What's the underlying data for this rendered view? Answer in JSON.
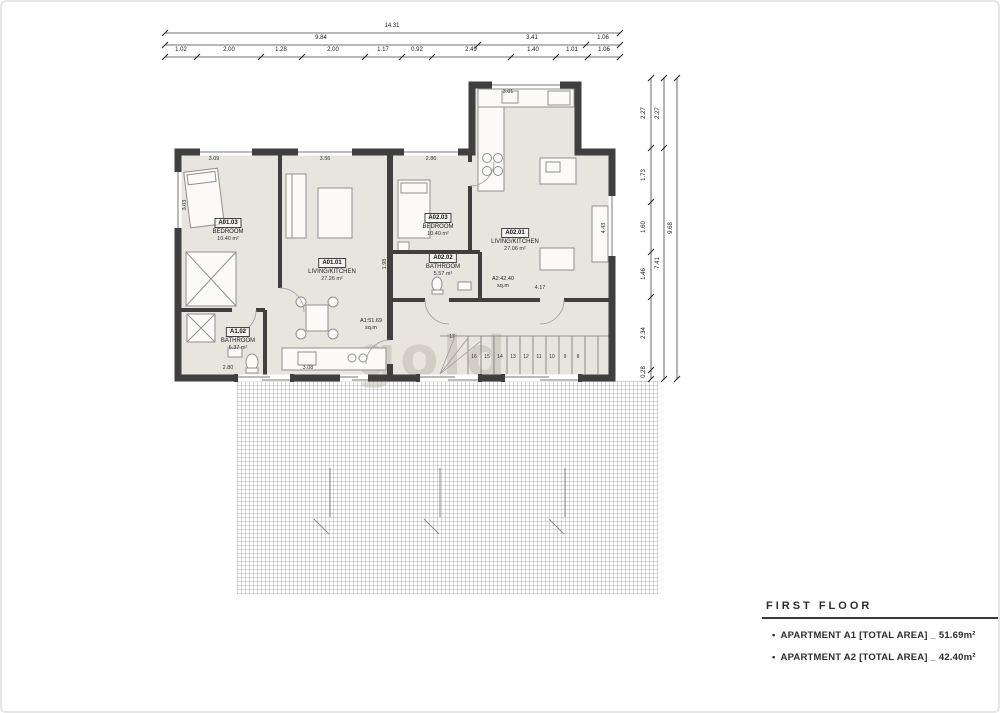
{
  "watermark": "gold",
  "colors": {
    "wall": "#3f3f3f",
    "floor": "#e8e5df",
    "hatch": "#9a9a9a"
  },
  "legend": {
    "title": "FIRST FLOOR",
    "bullet": "•",
    "items": [
      {
        "text": "APARTMENT A1 [TOTAL AREA] _ 51.69m²"
      },
      {
        "text": "APARTMENT A2 [TOTAL AREA] _ 42.40m²"
      }
    ]
  },
  "dimensions": {
    "top": {
      "total": "14.31",
      "row2": [
        "9.84",
        "3.41",
        "1.06"
      ],
      "row3": [
        "1.02",
        "2.00",
        "1.28",
        "2.00",
        "1.17",
        "0.92",
        "2.49",
        "1.40",
        "1.01",
        "1.06"
      ]
    },
    "right": {
      "total": "9.68",
      "row2": [
        "2.27",
        "7.41"
      ],
      "row3": [
        "2.27",
        "1.73",
        "1.60",
        "1.46",
        "2.34",
        "0.28"
      ]
    },
    "interior": [
      "3.09",
      "3.56",
      "2.86",
      "3.01",
      "4.17",
      "1.98",
      "2.80",
      "3.08",
      "4.43",
      "3.03"
    ]
  },
  "rooms": [
    {
      "id": "A01.03",
      "name": "BEDROOM",
      "area": "10.40 m²"
    },
    {
      "id": "A01.01",
      "name": "LIVING/KITCHEN",
      "area": "27.26 m²"
    },
    {
      "id": "A1.02",
      "name": "BATHROOM",
      "area": "6.37 m²"
    },
    {
      "id": "A02.03",
      "name": "BEDROOM",
      "area": "10.40 m²"
    },
    {
      "id": "A02.02",
      "name": "BATHROOM",
      "area": "5.57 m²"
    },
    {
      "id": "A02.01",
      "name": "LIVING/KITCHEN",
      "area": "27.06 m²"
    }
  ],
  "area_tags": [
    {
      "line1": "A1:51.69",
      "line2": "sq.m"
    },
    {
      "line1": "A2:42.40",
      "line2": "sq.m"
    }
  ],
  "stairs": {
    "numbers": [
      "17",
      "16",
      "15",
      "14",
      "13",
      "12",
      "11",
      "10",
      "9",
      "8"
    ]
  }
}
